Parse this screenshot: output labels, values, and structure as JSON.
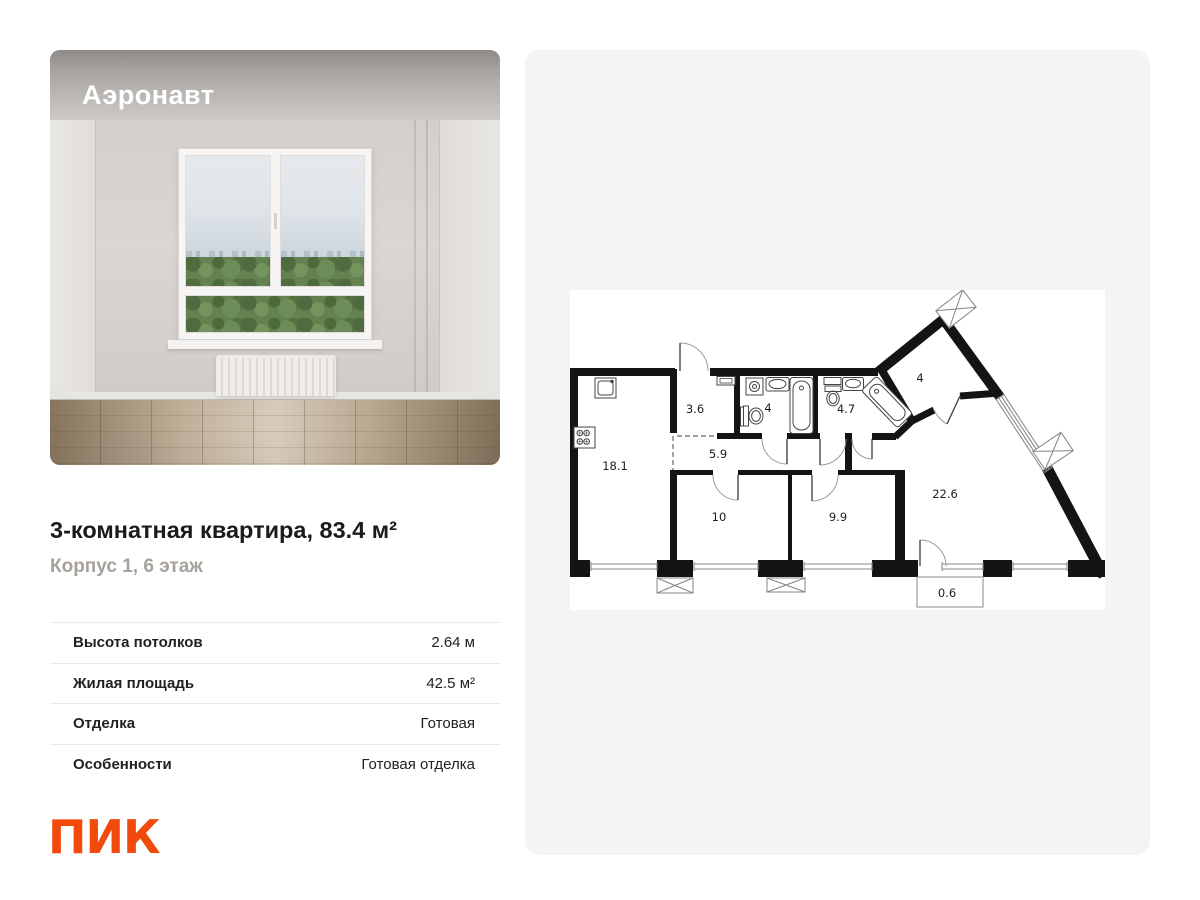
{
  "listing": {
    "building_name": "Аэронавт",
    "title": "3-комнатная квартира, 83.4 м²",
    "subtitle": "Корпус 1, 6 этаж",
    "specs": [
      {
        "label": "Высота потолков",
        "value": "2.64 м"
      },
      {
        "label": "Жилая площадь",
        "value": "42.5 м²"
      },
      {
        "label": "Отделка",
        "value": "Готовая"
      },
      {
        "label": "Особенности",
        "value": "Готовая отделка"
      }
    ],
    "developer": "ПИК"
  },
  "floorplan": {
    "rooms": [
      {
        "name": "kitchen",
        "area": "18.1"
      },
      {
        "name": "hallway",
        "area": "3.6"
      },
      {
        "name": "bathroom-1",
        "area": "4"
      },
      {
        "name": "corridor",
        "area": "5.9"
      },
      {
        "name": "bathroom-2",
        "area": "4.7"
      },
      {
        "name": "wardrobe",
        "area": "4"
      },
      {
        "name": "bedroom-1",
        "area": "10"
      },
      {
        "name": "bedroom-2",
        "area": "9.9"
      },
      {
        "name": "living-room",
        "area": "22.6"
      },
      {
        "name": "balcony",
        "area": "0.6"
      }
    ]
  },
  "colors": {
    "brand_orange": "#F2490C",
    "panel_bg": "#F5F4F2",
    "subtitle_gray": "#A6A19B"
  }
}
